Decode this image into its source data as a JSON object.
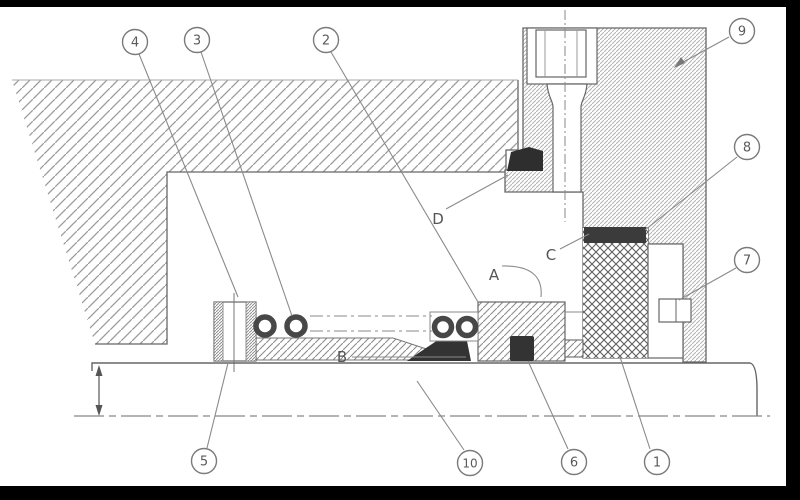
{
  "drawing": {
    "callouts": [
      {
        "label": "4"
      },
      {
        "label": "3"
      },
      {
        "label": "2"
      },
      {
        "label": "9"
      },
      {
        "label": "8"
      },
      {
        "label": "7"
      },
      {
        "label": "5"
      },
      {
        "label": "10"
      },
      {
        "label": "6"
      },
      {
        "label": "1"
      }
    ],
    "letters": [
      {
        "char": "A"
      },
      {
        "char": "B"
      },
      {
        "char": "C"
      },
      {
        "char": "D"
      }
    ],
    "colors": {
      "line": "#666666",
      "hatch": "#9b9b9b",
      "dark_fill": "#333333",
      "frame": "#000000",
      "background": "#ffffff"
    }
  }
}
